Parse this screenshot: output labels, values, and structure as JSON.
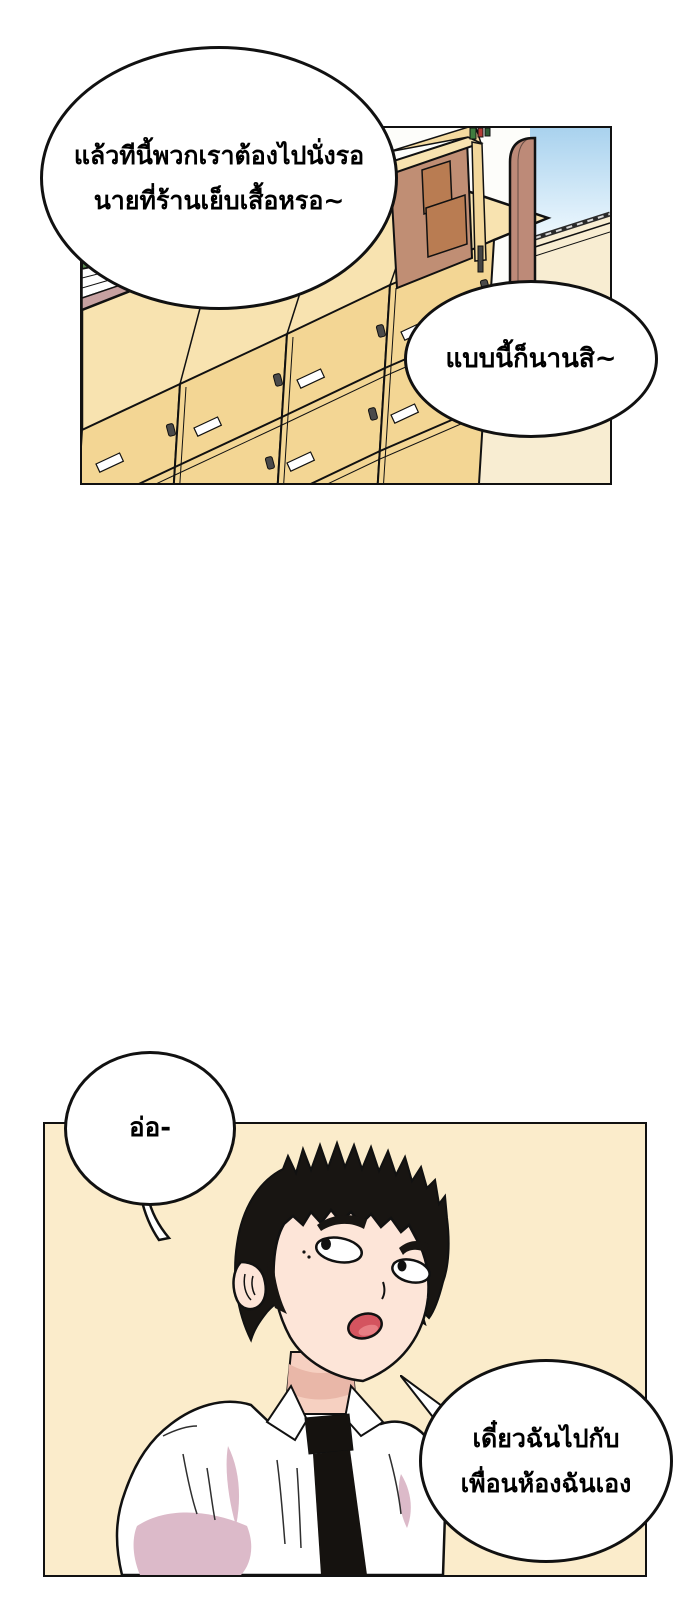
{
  "page": {
    "type": "webtoon comic page",
    "background": "#ffffff",
    "panel_count": 2
  },
  "colors": {
    "outline": "#111111",
    "panel2_bg": "#fbeccb",
    "bubble_fill": "#ffffff",
    "locker_front": "#f3d694",
    "locker_top": "#f8e3b0",
    "chalkboard_green": "#5a8b52",
    "stripe_mauve": "#c7a1a1",
    "wood_pillar": "#bd8a78",
    "cabinet_inner": "#c08e74",
    "box_brown": "#b97c52",
    "sky_top": "#a9d2ee",
    "sky_bottom": "#eef8fe",
    "floor": "#f8edd2",
    "skin": "#fde5d8",
    "skin_shadow": "#e9b7a8",
    "shirt_shadow": "#dcbac9",
    "hair": "#181512",
    "tie": "#15120f",
    "mouth": "#d4545f"
  },
  "panel1": {
    "name": "locker hallway scene",
    "elements": [
      "chalkboard",
      "wall stripes",
      "locker bank",
      "open cabinet with boxes",
      "wood pillar",
      "window with sky"
    ]
  },
  "panel2": {
    "name": "boy speaking scene",
    "elements": [
      "black spiky hair",
      "rolled eyes",
      "open mouth",
      "white shirt",
      "black tie"
    ]
  },
  "bubbles": {
    "b1": {
      "line1": "แล้วทีนี้พวกเราต้องไปนั่งรอ",
      "line2": "นายที่ร้านเย็บเสื้อหรอ~"
    },
    "b2": {
      "line1": "แบบนี้ก็นานสิ~"
    },
    "b3": {
      "line1": "อ่อ-"
    },
    "b4": {
      "line1": "เดี๋ยวฉันไปกับ",
      "line2": "เพื่อนห้องฉันเอง"
    }
  }
}
